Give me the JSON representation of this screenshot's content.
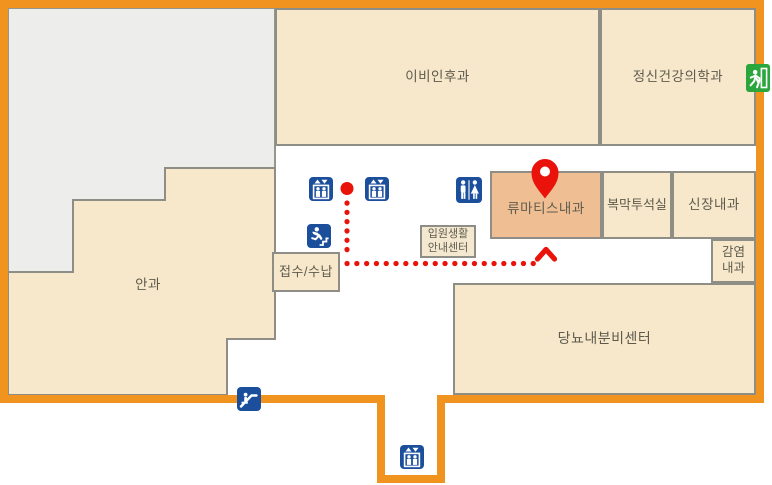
{
  "map": {
    "rooms": {
      "ent": {
        "label": "이비인후과"
      },
      "psychiatry": {
        "label": "정신건강의학과"
      },
      "rheumatology": {
        "label": "류마티스내과"
      },
      "peritoneal_dialysis": {
        "label": "복막투석실"
      },
      "nephrology": {
        "label": "신장내과"
      },
      "infectious_disease": {
        "line1": "감염",
        "line2": "내과"
      },
      "diabetes_endocrine": {
        "label": "당뇨내분비센터"
      },
      "ophthalmology": {
        "label": "안과"
      },
      "reception": {
        "label": "접수/수납"
      },
      "inpatient_info": {
        "line1": "입원생활",
        "line2": "안내센터"
      }
    },
    "icons": {
      "elevator": "elevator",
      "restroom": "restroom",
      "emergency_stairs": "emergency-stairs",
      "escalator": "escalator",
      "emergency_exit": "emergency-exit",
      "destination_pin": "destination-pin"
    },
    "colors": {
      "outline_orange": "#F0931F",
      "room_beige": "#F7E8CC",
      "highlight_salmon": "#F0BE93",
      "unlabeled_gray": "#EDEDEC",
      "room_border_gray": "#8F8E86",
      "icon_blue": "#1B4E9B",
      "route_red": "#E9130C",
      "exit_green": "#2AA63C",
      "label_text": "#5E5B4D"
    }
  }
}
